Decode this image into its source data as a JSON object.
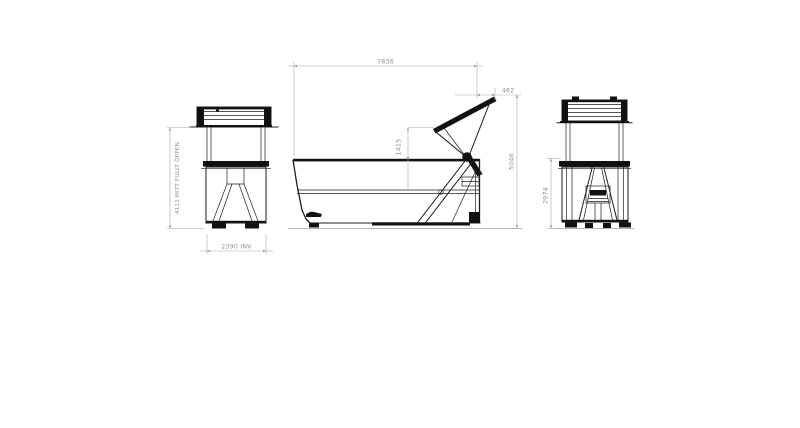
{
  "drawing": {
    "dimensions": {
      "front_inner_width": "2390 INV",
      "front_height_open": "4111 MITT FULLT ÖPPEN",
      "side_overall_length": "7836",
      "side_rear_overhang": "462",
      "side_lid_extension": "1415",
      "side_overall_height_open": "5046",
      "rear_height": "2974"
    },
    "colors": {
      "background": "#ffffff",
      "object_line": "#1e1e1e",
      "solid_fill": "#111111",
      "dimension_line": "#a9a9a9",
      "dimension_text": "#8f8f8f"
    }
  }
}
